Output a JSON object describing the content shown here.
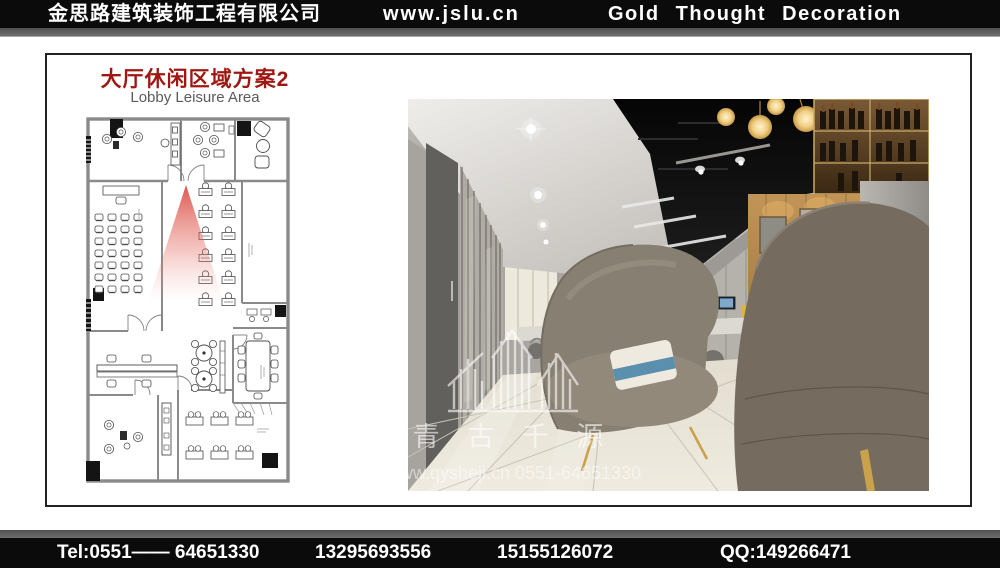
{
  "header": {
    "company": "金思路建筑装饰工程有限公司",
    "website": "www.jslu.cn",
    "tagline": "Gold  Thought  Decoration"
  },
  "slide": {
    "title": "大厅休闲区域方案2",
    "subtitle": "Lobby Leisure Area"
  },
  "photo": {
    "watermark_name": "青 古 千 源",
    "watermark_contact": "www.qysheji.cn 0551-64651330",
    "watermark_logo_icon": "building-skyline-icon"
  },
  "footer": {
    "tel": "Tel:0551—— 64651330",
    "mobile1": "13295693556",
    "mobile2": "15155126072",
    "qq": "QQ:149266471"
  },
  "colors": {
    "accent_red": "#9e1712",
    "bar_black": "#0b0b0b",
    "stripe_gray": "#666666",
    "highlight_arrow_red": "#d4281e",
    "chair_gold": "#c9a24b"
  }
}
